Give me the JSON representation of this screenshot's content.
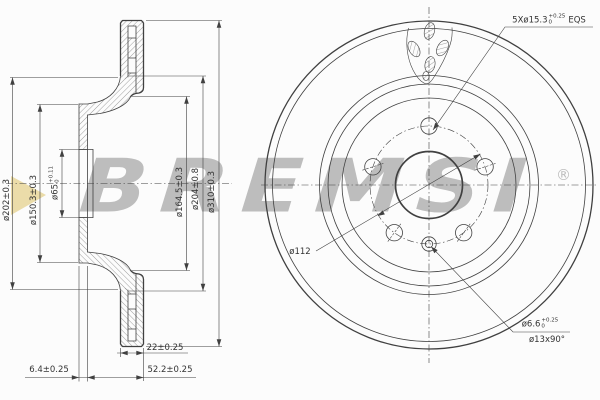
{
  "watermark": {
    "brand": "BREMSI",
    "registered": "®"
  },
  "theme": {
    "bg": "#fcfcfc",
    "ink": "#404040",
    "hatch": "#6a6a6a",
    "wm_gray": "#bdbdbd",
    "wm_yellow": "#e9d8a0"
  },
  "dims": {
    "hat_outer": "ø202±0.3",
    "flange": "ø150.3±0.3",
    "bore_main": "ø65",
    "bore_sup": "+0.11",
    "bore_sub": "0",
    "inner_friction": "ø164.5±0.3",
    "vent_inner": "ø204±0.8",
    "outer": "ø310±0.3",
    "flange_thickness": "6.4±0.25",
    "disc_thickness": "22±0.25",
    "total_height": "52.2±0.25"
  },
  "front_labels": {
    "bolt_main": "5Xø15.3",
    "bolt_sup": "+0.25",
    "bolt_sub": "0",
    "bolt_suffix": "EQS",
    "bolt_circle": "ø112",
    "screw_main": "ø6.6",
    "screw_sup": "+0.25",
    "screw_sub": "0",
    "countersink": "ø13x90°"
  }
}
